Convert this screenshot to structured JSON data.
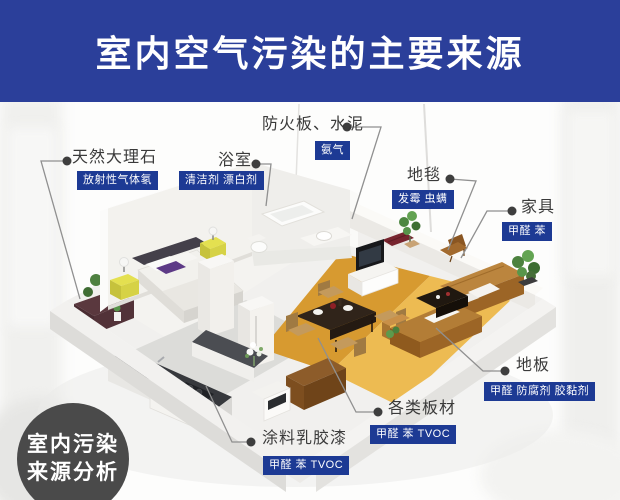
{
  "header": {
    "title": "室内空气污染的主要来源"
  },
  "analysis_badge": {
    "line1": "室内污染",
    "line2": "来源分析"
  },
  "labels": {
    "marble": {
      "name": "天然大理石",
      "pollutants": "放射性气体氡"
    },
    "bathroom": {
      "name": "浴室",
      "pollutants": "清洁剂 漂白剂"
    },
    "fireboard": {
      "name": "防火板、水泥",
      "pollutants": "氨气"
    },
    "carpet": {
      "name": "地毯",
      "pollutants": "发霉 虫螨"
    },
    "furniture": {
      "name": "家具",
      "pollutants": "甲醛 苯"
    },
    "floor": {
      "name": "地板",
      "pollutants": "甲醛 防腐剂 胶黏剂"
    },
    "boards": {
      "name": "各类板材",
      "pollutants": "甲醛 苯 TVOC"
    },
    "paint": {
      "name": "涂料乳胶漆",
      "pollutants": "甲醛 苯 TVOC"
    }
  },
  "colors": {
    "banner_blue": "#2b3f9a",
    "badge_blue": "#1d3a94",
    "wood_floor": "#e2a438",
    "analysis_circle_gray": "#4a4a4a",
    "leader_line_gray": "#909090"
  }
}
